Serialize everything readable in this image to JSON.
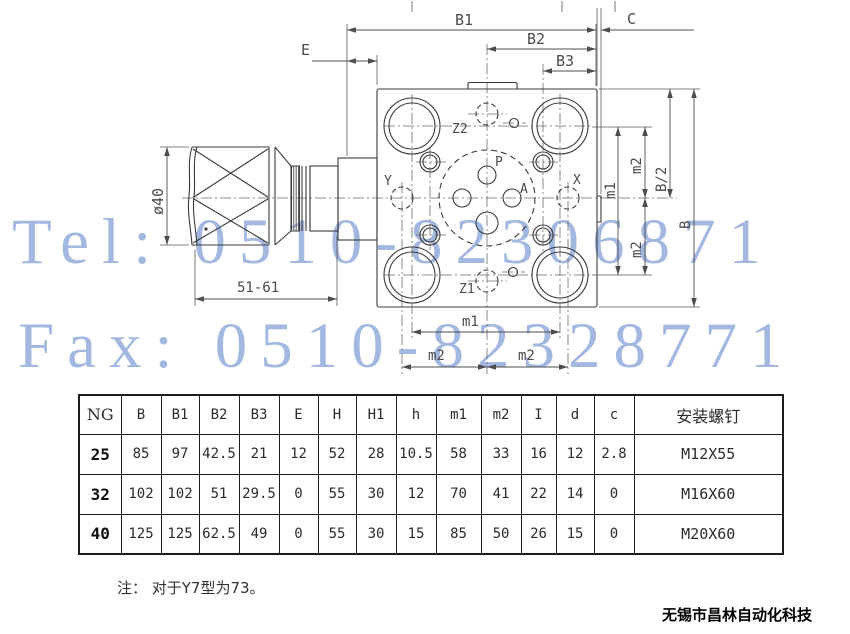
{
  "watermarks": {
    "tel": "Tel: 0510-82306871",
    "fax": "Fax: 0510-82328771",
    "color": "#a3b8e0"
  },
  "drawing": {
    "line_color": "#3b3b3b",
    "dimension_labels": {
      "b1": "B1",
      "b2": "B2",
      "b3": "B3",
      "c": "C",
      "e": "E",
      "knob_diameter": "ø40",
      "adjust_length": "51-61",
      "m1": "m1",
      "m2": "m2",
      "b_half": "B/2",
      "b": "B"
    },
    "port_labels": {
      "p": "P",
      "a": "A",
      "x": "X",
      "y": "Y",
      "z1": "Z1",
      "z2": "Z2"
    }
  },
  "table": {
    "headers": [
      "NG",
      "B",
      "B1",
      "B2",
      "B3",
      "E",
      "H",
      "H1",
      "h",
      "m1",
      "m2",
      "I",
      "d",
      "c",
      "安装螺钉"
    ],
    "rows": [
      [
        "25",
        "85",
        "97",
        "42.5",
        "21",
        "12",
        "52",
        "28",
        "10.5",
        "58",
        "33",
        "16",
        "12",
        "2.8",
        "M12X55"
      ],
      [
        "32",
        "102",
        "102",
        "51",
        "29.5",
        "0",
        "55",
        "30",
        "12",
        "70",
        "41",
        "22",
        "14",
        "0",
        "M16X60"
      ],
      [
        "40",
        "125",
        "125",
        "62.5",
        "49",
        "0",
        "55",
        "30",
        "15",
        "85",
        "50",
        "26",
        "15",
        "0",
        "M20X60"
      ]
    ]
  },
  "note": "注： 对于Y7型为73。",
  "footer": {
    "company": "无锡市昌林自动化科技"
  }
}
